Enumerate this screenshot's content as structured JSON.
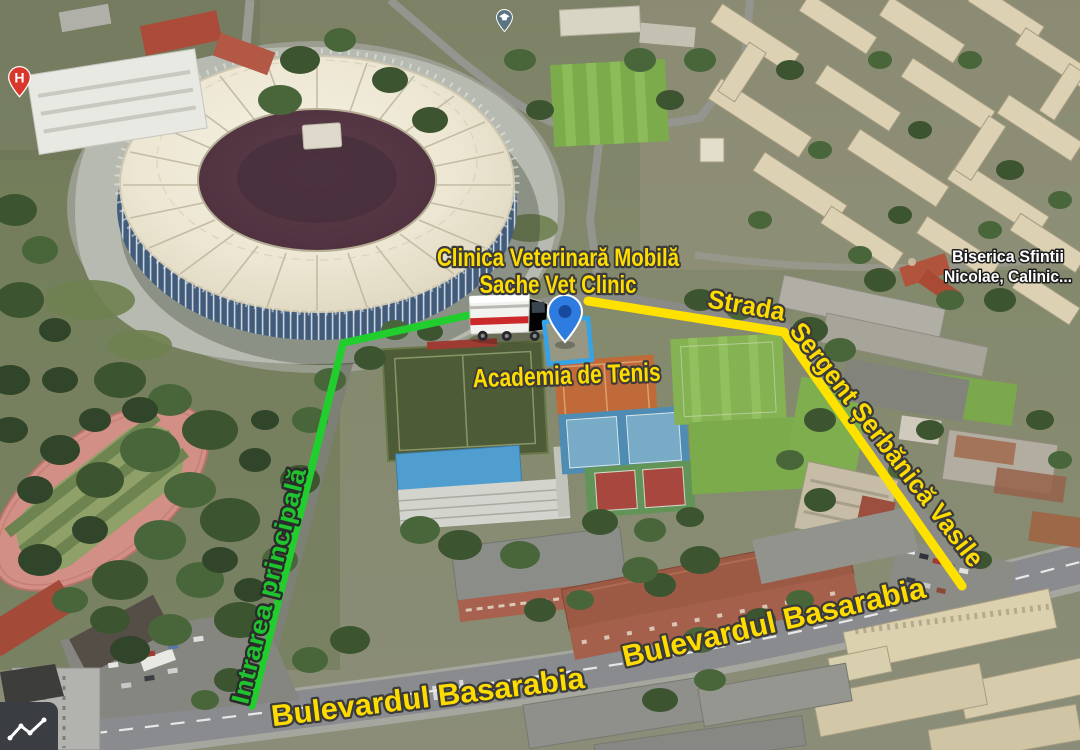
{
  "scene": {
    "labels": {
      "clinic_line1": "Clinica Veterinară Mobilă",
      "clinic_line2": "Sache Vet Clinic",
      "tennis_academy": "Academia de Tenis",
      "street_prefix": "Strada",
      "street_name": "Sergent Șerbănică Vasile",
      "entrance": "Intrarea principală",
      "boulevard_1": "Bulevardul Basarabia",
      "boulevard_2": "Bulevardul Basarabia",
      "church_line1": "Biserica Sfintii",
      "church_line2": "Nicolae, Calinic..."
    },
    "markers": {
      "hospital_letter": "H"
    },
    "colors": {
      "route_yellow": "#FFE100",
      "route_green": "#21CE2E",
      "label_yellow": "#FFDC00",
      "label_green": "#1EC32E",
      "label_white": "#FFFFFF",
      "pin_blue": "#2F7CE0",
      "pin_blue_inner": "#174A9E",
      "building_highlight_blue": "#36A3E6",
      "hospital_pin_red": "#D9372C",
      "education_pin_gray": "#5C7382"
    }
  }
}
